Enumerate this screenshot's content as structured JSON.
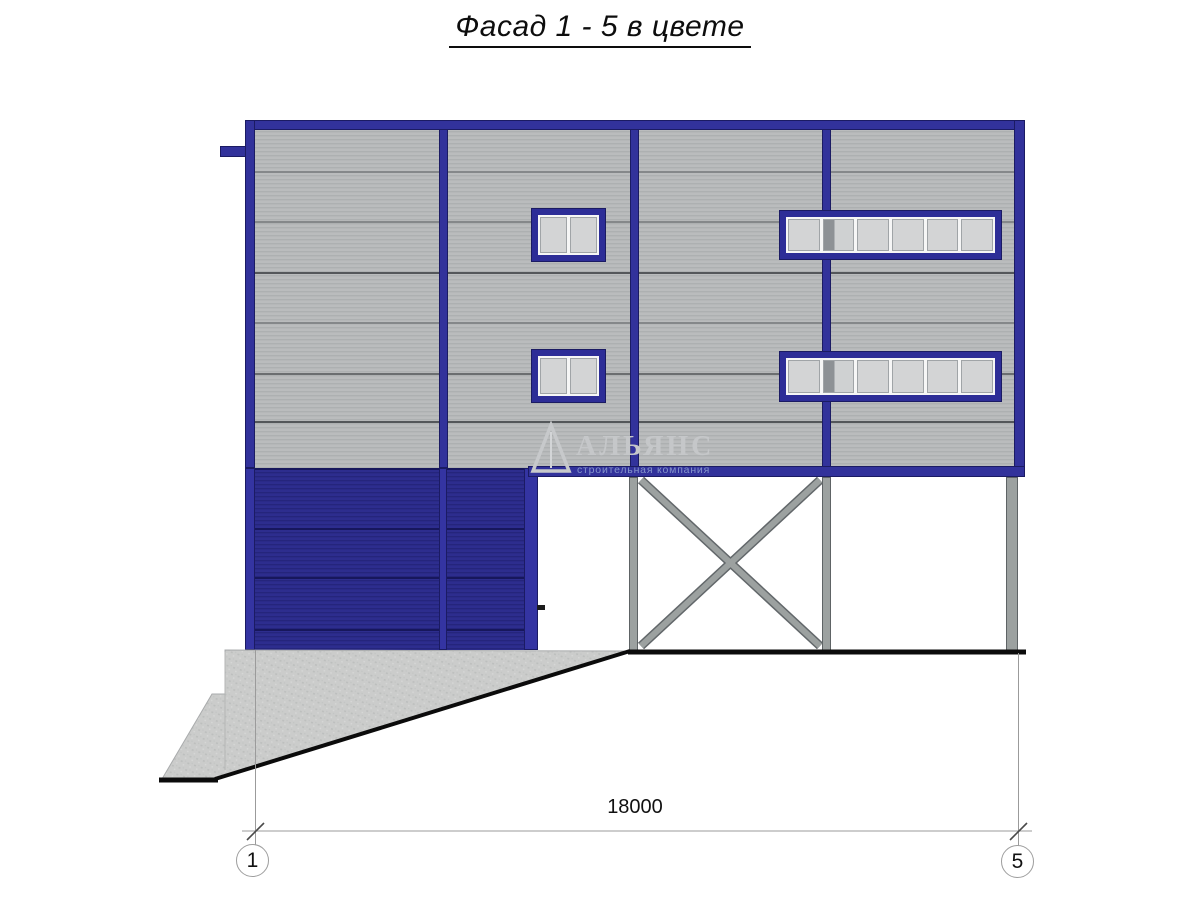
{
  "title": "Фасад 1 - 5 в цвете",
  "dimension": {
    "value": "18000",
    "axis_start": "1",
    "axis_end": "5"
  },
  "watermark": {
    "name": "АЛЬЯНС",
    "subtitle": "строительная компания"
  },
  "colors": {
    "frame_blue": "#32329b",
    "frame_blue2": "#3434a2",
    "window_blue": "#2d2d97",
    "door_navy": "#2a2a88",
    "panel_gray": "#b5b7b8",
    "steel_gray": "#9ca1a0",
    "concrete_gray": "#cbcccb",
    "ground_black": "#0b0b0b",
    "dim_gray": "#9b9b9b"
  }
}
